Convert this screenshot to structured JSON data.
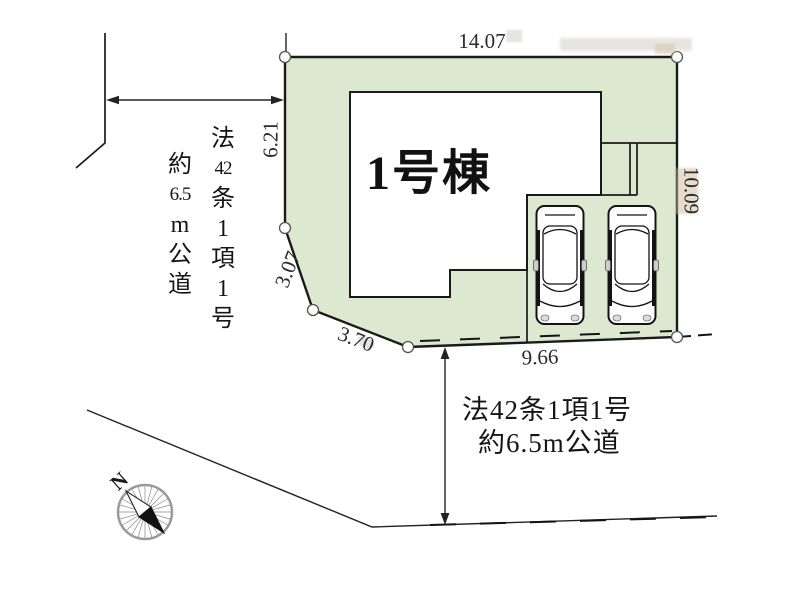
{
  "plan": {
    "building_label": "1号棟",
    "dimensions": {
      "top": "14.07",
      "left": "6.21",
      "diag_upper": "3.07",
      "diag_lower": "3.70",
      "bottom": "9.66",
      "right": "10.09"
    },
    "road_note_left": {
      "col1": [
        "法",
        "42",
        "条",
        "1",
        "項",
        "1",
        "号"
      ],
      "col2": [
        "約",
        "6.5",
        "m",
        "公",
        "道"
      ]
    },
    "road_note_bottom": {
      "line1": "法42条1項1号",
      "line2": "約6.5m公道"
    },
    "compass": {
      "north_label": "N"
    }
  },
  "colors": {
    "plot-fill": "#dce8cf",
    "line": "#1a1a1a",
    "text": "#1c1c1c"
  }
}
